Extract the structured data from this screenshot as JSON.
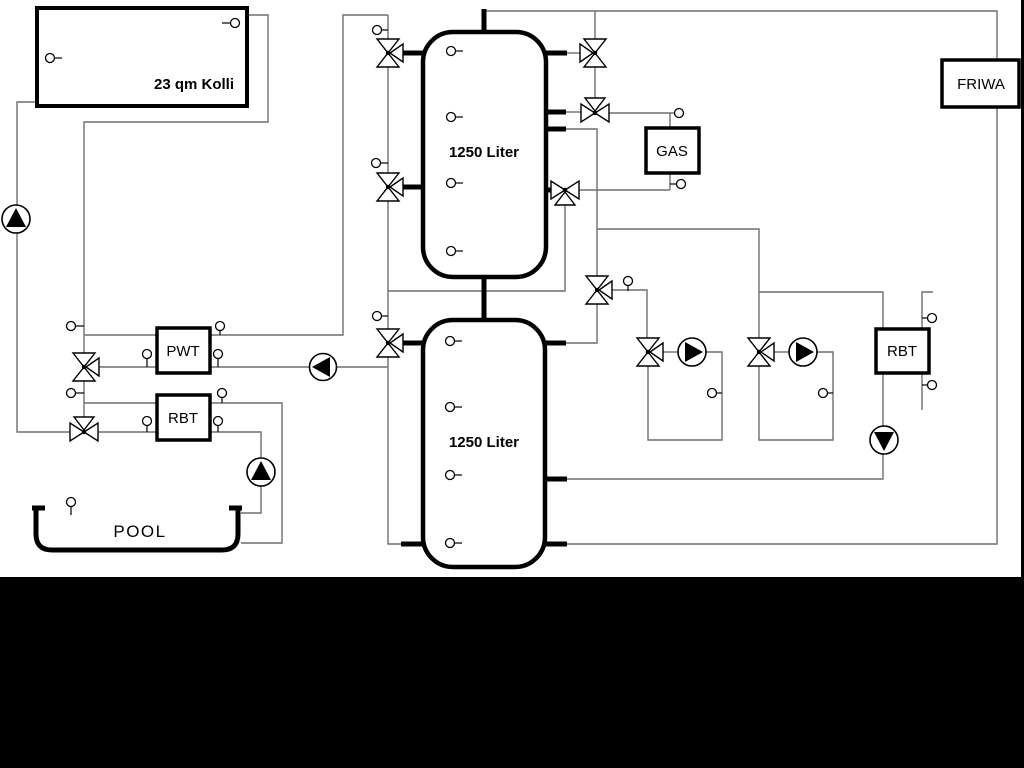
{
  "diagram": {
    "collector_label": "23 qm Kolli",
    "tank1_label": "1250 Liter",
    "tank2_label": "1250 Liter",
    "gas_label": "GAS",
    "friwa_label": "FRIWA",
    "pwt_label": "PWT",
    "rbt_left_label": "RBT",
    "rbt_right_label": "RBT",
    "pool_label": "POOL"
  },
  "colors": {
    "pipe": "#6e6e6e",
    "symbol": "#000000",
    "background": "#ffffff",
    "mask_bar": "#000000"
  }
}
